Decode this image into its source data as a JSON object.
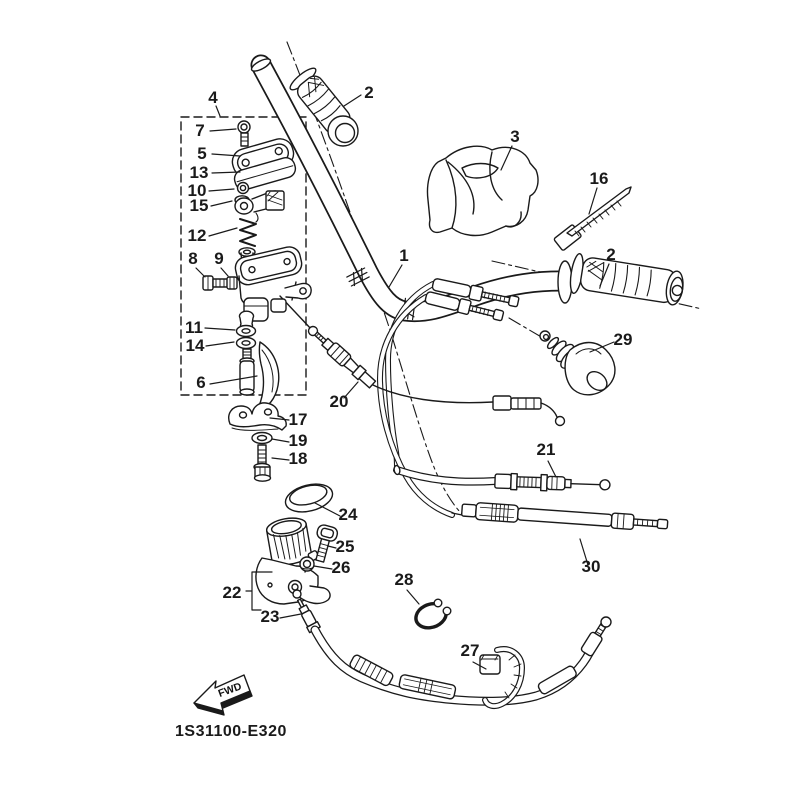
{
  "diagram": {
    "type": "exploded-parts-diagram",
    "code": "1S31100-E320",
    "fwd_marker": "FWD",
    "line_color": "#1a1a1a",
    "background": "#ffffff"
  },
  "part_labels": [
    {
      "part": "4"
    },
    {
      "part": "7"
    },
    {
      "part": "5"
    },
    {
      "part": "13"
    },
    {
      "part": "10"
    },
    {
      "part": "15"
    },
    {
      "part": "12"
    },
    {
      "part": "8"
    },
    {
      "part": "9"
    },
    {
      "part": "11"
    },
    {
      "part": "14"
    },
    {
      "part": "6"
    },
    {
      "part": "2"
    },
    {
      "part": "3"
    },
    {
      "part": "16"
    },
    {
      "part": "1"
    },
    {
      "part": "2"
    },
    {
      "part": "29"
    },
    {
      "part": "20"
    },
    {
      "part": "17"
    },
    {
      "part": "19"
    },
    {
      "part": "18"
    },
    {
      "part": "24"
    },
    {
      "part": "25"
    },
    {
      "part": "26"
    },
    {
      "part": "22"
    },
    {
      "part": "23"
    },
    {
      "part": "28"
    },
    {
      "part": "21"
    },
    {
      "part": "30"
    },
    {
      "part": "27"
    }
  ]
}
